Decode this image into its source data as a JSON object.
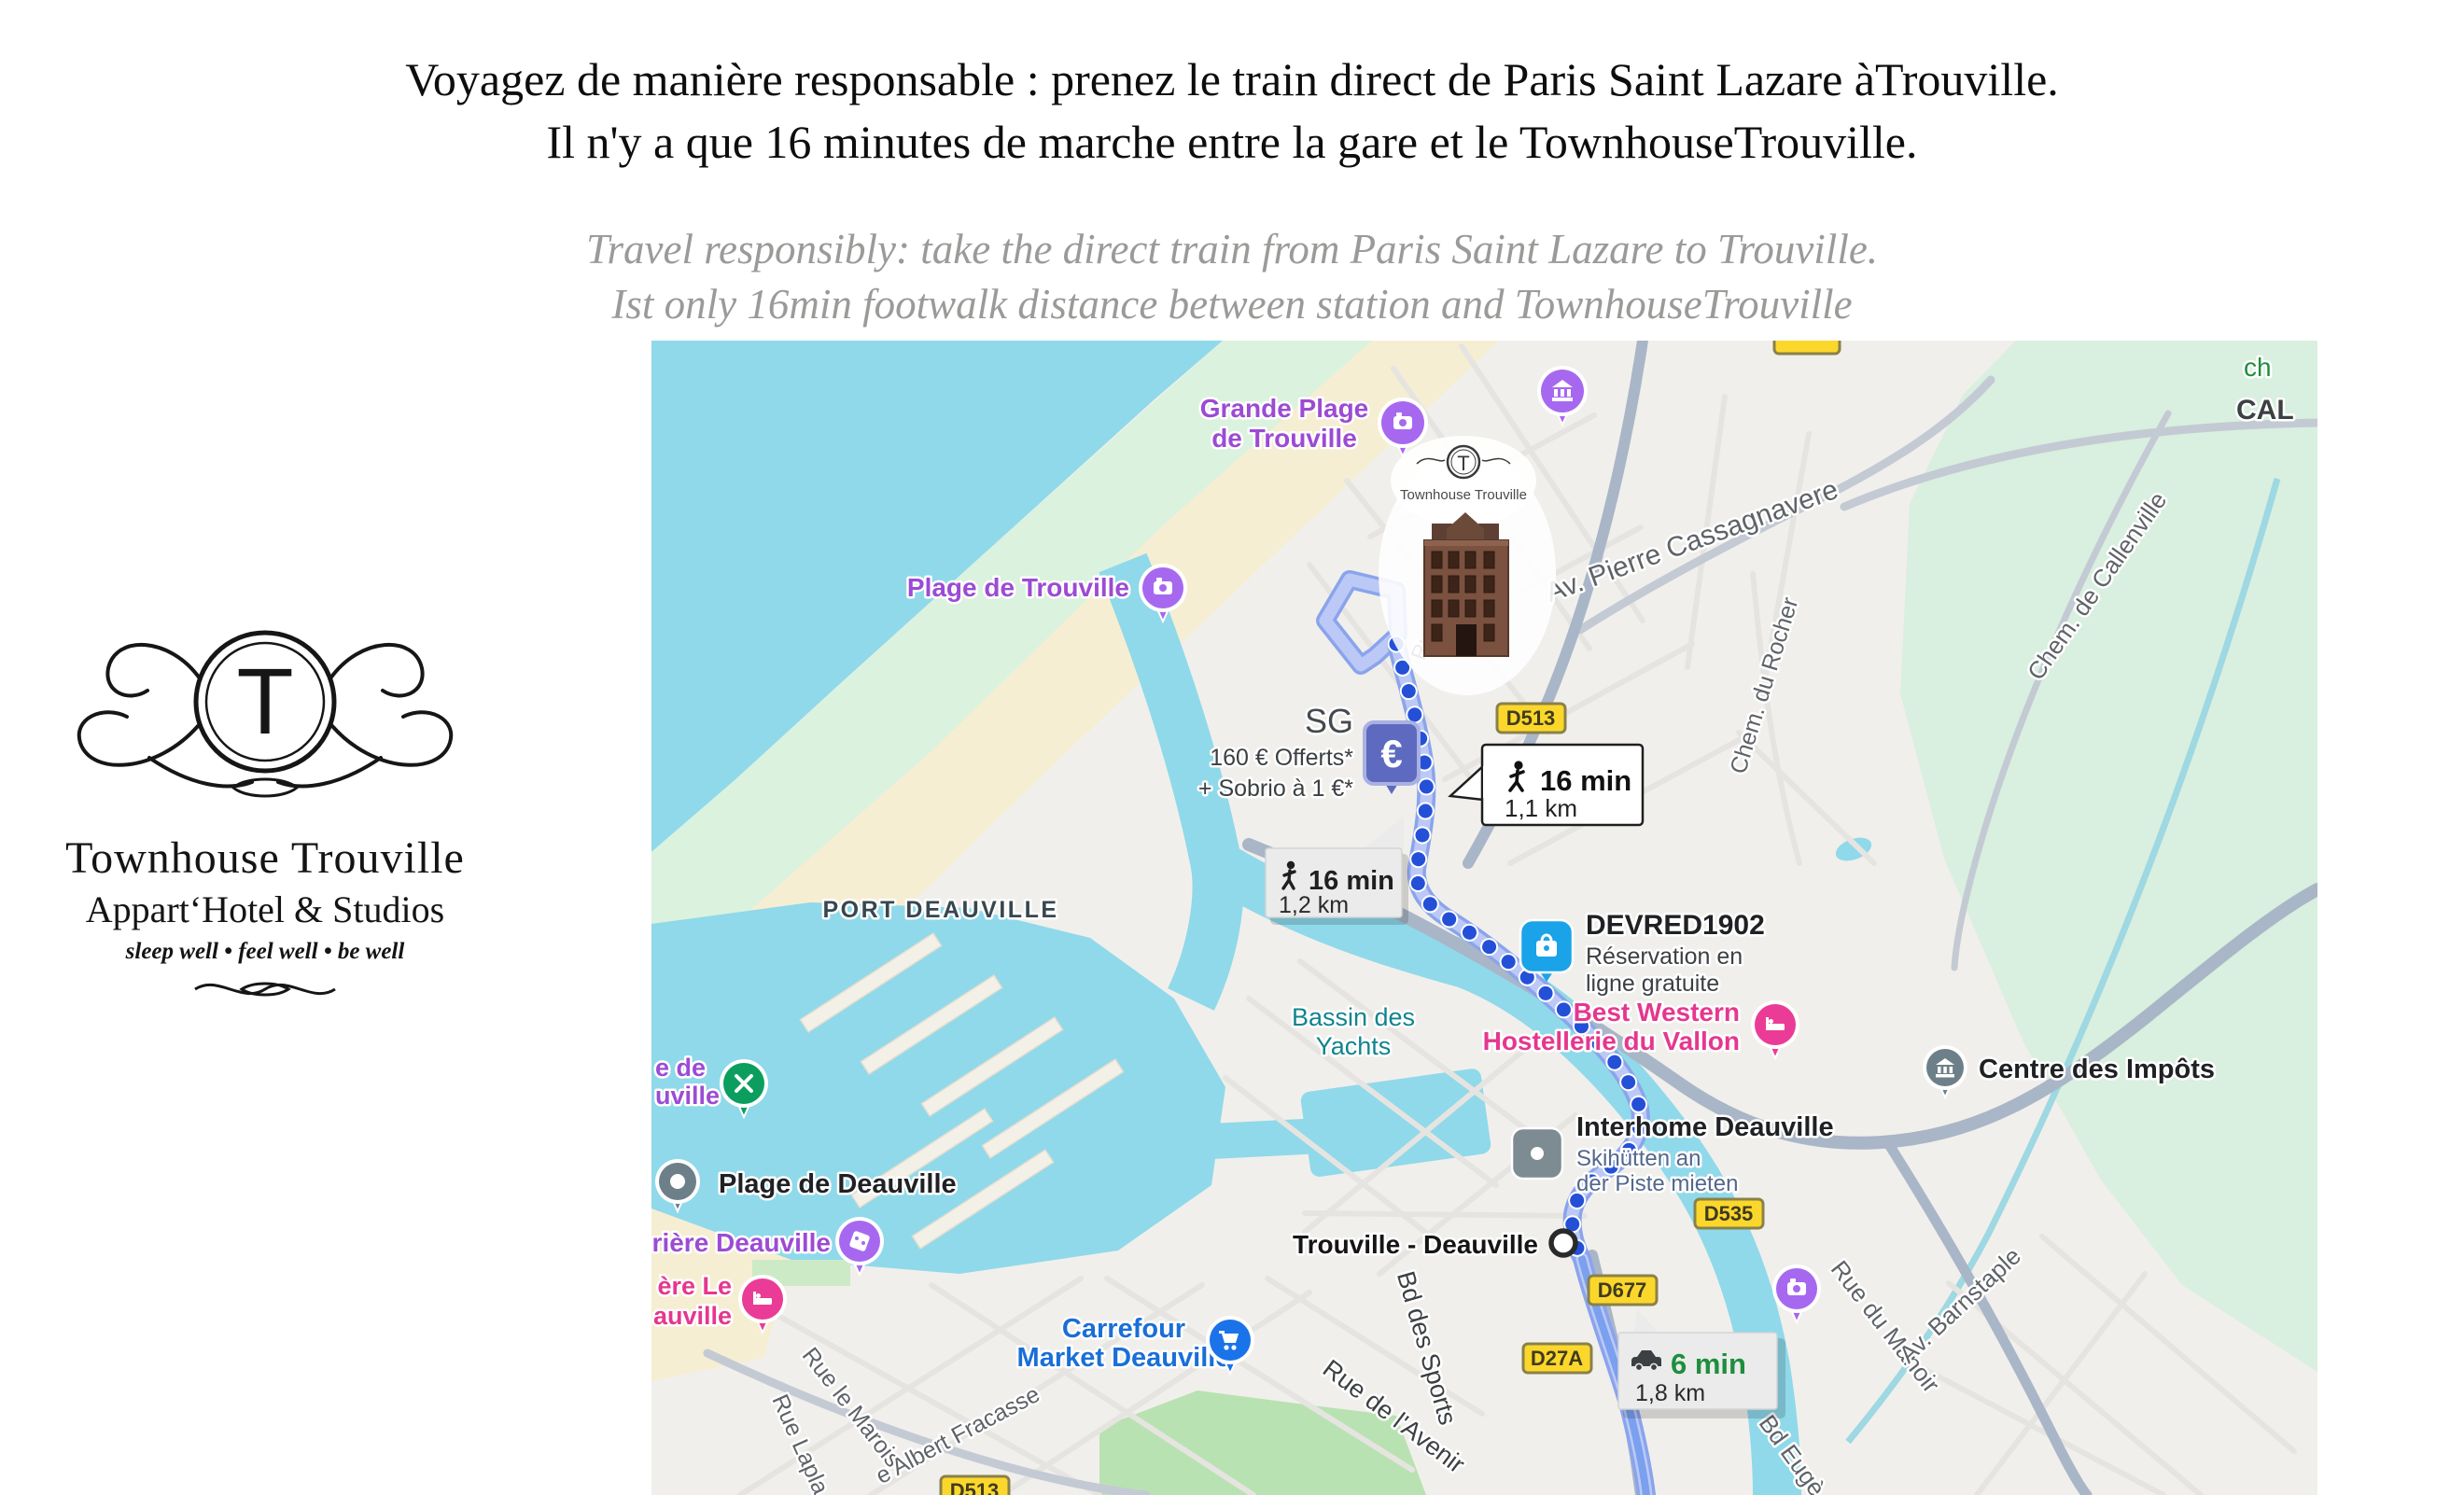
{
  "header": {
    "fr_line1": "Voyagez de manière responsable : prenez le train direct de Paris Saint Lazare àTrouville.",
    "fr_line2": "Il n'y a que 16 minutes de marche entre la gare et le TownhouseTrouville.",
    "en_line1": "Travel responsibly: take the direct train from Paris Saint Lazare to Trouville.",
    "en_line2": "Ist only 16min footwalk distance between station and TownhouseTrouville"
  },
  "logo": {
    "monogram": "T",
    "name": "Townhouse Trouville",
    "subtitle": "Appart‘Hotel & Studios",
    "tagline": "sleep well • feel well • be well"
  },
  "map": {
    "euro_symbol": "€",
    "building_label": "Townhouse Trouville",
    "labels": {
      "grande_plage_1": "Grande Plage",
      "grande_plage_2": "de Trouville",
      "plage_trouville": "Plage de Trouville",
      "port_deauville": "PORT DEAUVILLE",
      "bassin_1": "Bassin des",
      "bassin_2": "Yachts",
      "sg": "SG",
      "sg_offer1": "160 € Offerts*",
      "sg_offer2": "+ Sobrio à 1 €*",
      "devred": "DEVRED1902",
      "devred_sub1": "Réservation en",
      "devred_sub2": "ligne gratuite",
      "best_western_1": "Best Western",
      "best_western_2": "Hostellerie du Vallon",
      "centre_impots": "Centre des Impôts",
      "interhome": "Interhome Deauville",
      "interhome_sub1": "Skihütten an",
      "interhome_sub2": "der Piste mieten",
      "station": "Trouville - Deauville",
      "carrefour_1": "Carrefour",
      "carrefour_2": "Market Deauville",
      "plage_deauville": "Plage de Deauville",
      "trunc_green_1": "e de",
      "trunc_green_2": "uville",
      "trunc_casino": "rière Deauville",
      "trunc_hotel_1": "ère Le",
      "trunc_hotel_2": "auville",
      "trunc_ch": "ch",
      "trunc_cal": "CAL"
    },
    "roads": {
      "av_pierre": "Av. Pierre Cassagnavere",
      "chem_rocher": "Chem. du Rocher",
      "chem_callenville": "Chem. de Callenville",
      "rue_manoir": "Rue du Manoir",
      "av_barnstaple": "Av. Barnstaple",
      "bd_eugene": "Bd Eugè",
      "bd_sports": "Bd des Sports",
      "rue_avenir": "Rue de l'Avenir",
      "rue_marois": "Rue le Marois",
      "rue_laplace": "Rue Lapla",
      "albert_fracasse": "e Albert Fracasse",
      "ru_short": "Ru"
    },
    "badges": {
      "d513": "D513",
      "d535": "D535",
      "d677": "D677",
      "d27a": "D27A",
      "d513_bottom": "D513"
    },
    "callouts": {
      "walk_primary_time": "16 min",
      "walk_primary_dist": "1,1 km",
      "walk_secondary_time": "16 min",
      "walk_secondary_dist": "1,2 km",
      "drive_time": "6 min",
      "drive_dist": "1,8 km"
    }
  },
  "colors": {
    "water": "#8fd9ea",
    "route_dot_blue": "#2450d8",
    "route_band": "#b9c6f4",
    "badge_yellow": "#fcd72b",
    "poi_purple": "#a768f0",
    "poi_pink": "#ea3c96",
    "poi_green": "#0b9e5e",
    "ad_blue": "#1aa3e8",
    "carrefour_blue": "#1a73e8",
    "drive_time_green": "#1e8e3e",
    "label_purple": "#9c4bd4",
    "label_teal": "#11848e"
  }
}
